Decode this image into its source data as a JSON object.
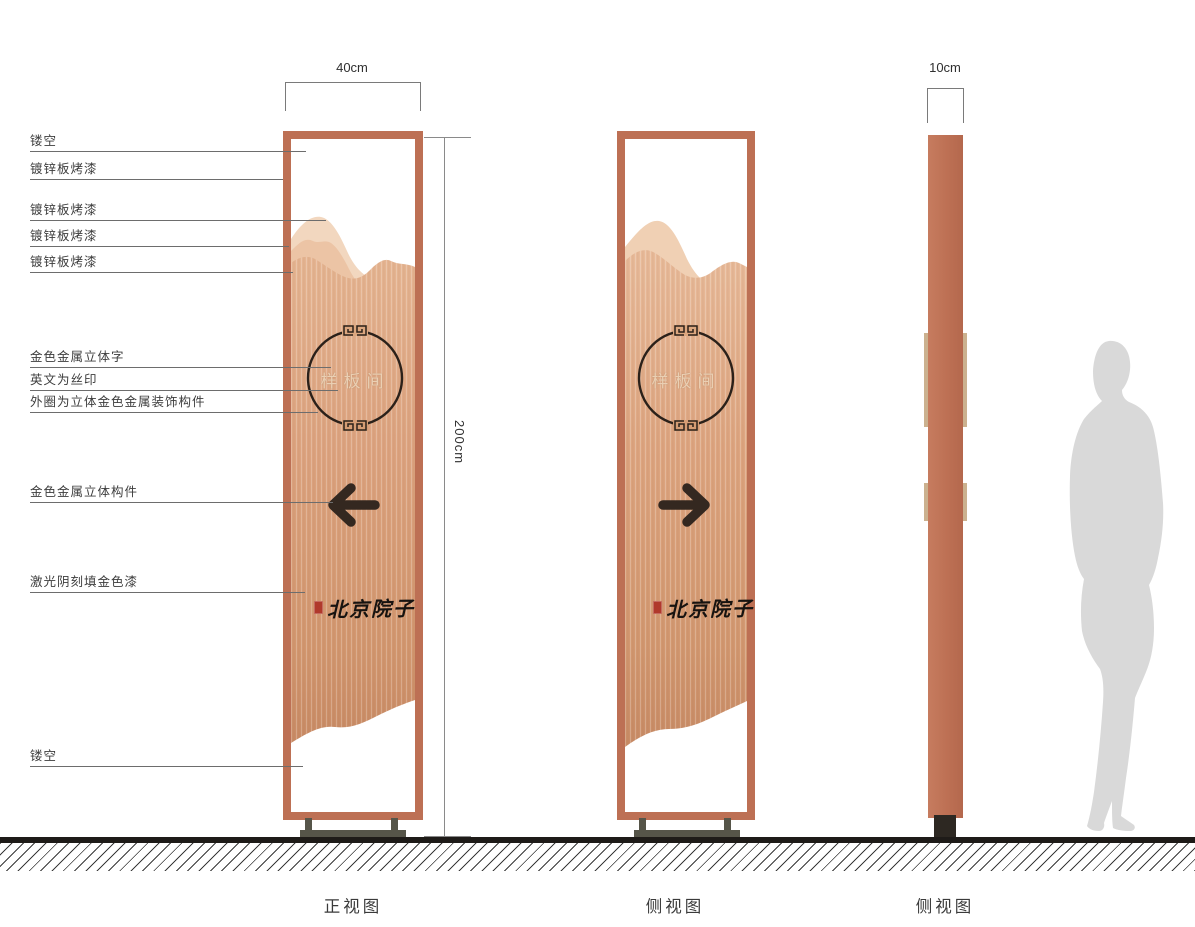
{
  "callouts": [
    {
      "label": "镂空"
    },
    {
      "label": "镀锌板烤漆"
    },
    {
      "label": "镀锌板烤漆"
    },
    {
      "label": "镀锌板烤漆"
    },
    {
      "label": "镀锌板烤漆"
    },
    {
      "label": "金色金属立体字"
    },
    {
      "label": "英文为丝印"
    },
    {
      "label": "外圈为立体金色金属装饰构件"
    },
    {
      "label": "金色金属立体构件"
    },
    {
      "label": "激光阴刻填金色漆"
    },
    {
      "label": "镂空"
    }
  ],
  "dimensions": {
    "front_width": "40cm",
    "height": "200cm",
    "side_width": "10cm"
  },
  "sign": {
    "room_label": "样板间",
    "brand_name": "北京院子"
  },
  "captions": {
    "front": "正视图",
    "side1": "侧视图",
    "side2": "侧视图"
  },
  "colors": {
    "frame": "#bd7054",
    "copper_light": "#f2d7bf",
    "copper_mid": "#e0ac87",
    "copper_dark": "#c98a66",
    "seal_red": "#b0392b",
    "base_stand": "#565549",
    "silhouette": "#d9d9d9",
    "arrow": "#342820"
  }
}
